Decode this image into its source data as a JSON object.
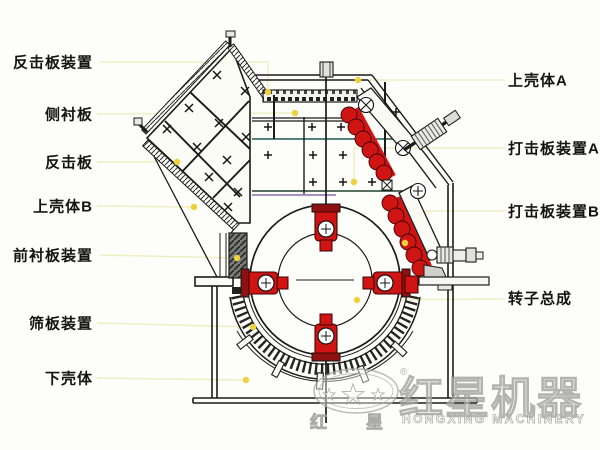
{
  "diagram": {
    "left_labels": [
      {
        "text": "反击板装置"
      },
      {
        "text": "侧衬板"
      },
      {
        "text": "反击板"
      },
      {
        "text": "上壳体B"
      },
      {
        "text": "前衬板装置"
      },
      {
        "text": "筛板装置"
      },
      {
        "text": "下壳体"
      }
    ],
    "right_labels": [
      {
        "text": "上壳体A"
      },
      {
        "text": "打击板装置A"
      },
      {
        "text": "打击板装置B"
      },
      {
        "text": "转子总成"
      }
    ],
    "accent_colors": {
      "hammer_red": "#d01414",
      "leader_line_yellow": "#efedc2",
      "marker_dot_yellow": "#edd23e",
      "drawing_line": "#1b1b1b"
    }
  },
  "watermark": {
    "brand_cn": "红星机器",
    "brand_en": "HONGXING MACHINERY",
    "reg": "®",
    "char_left": "红",
    "char_right": "星",
    "star": "★"
  }
}
